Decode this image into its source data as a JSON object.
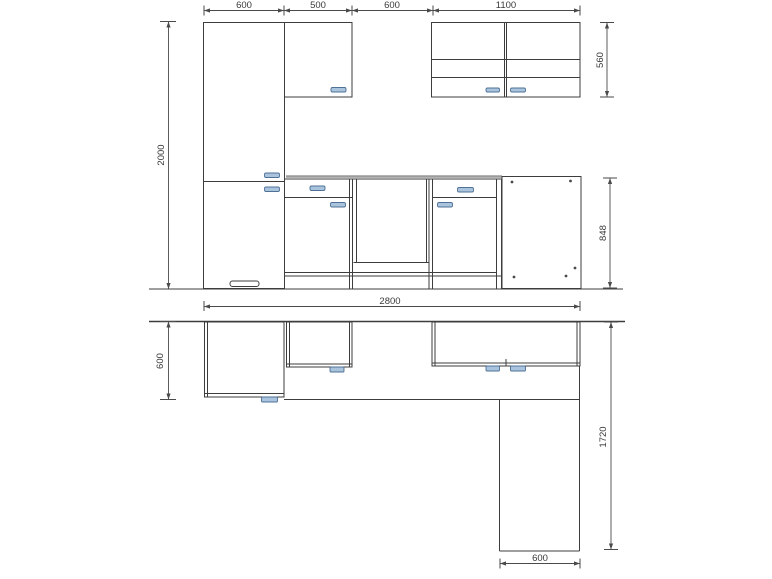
{
  "drawing": {
    "type": "kitchen-cad-drawing",
    "colors": {
      "line": "#3d3d3d",
      "worktop_gray": "#9b9b9b",
      "handle_fill": "#aac4dd",
      "handle_border": "#4f7196",
      "background": "#ffffff",
      "dimension_text": "#3a3a3a"
    },
    "dims": {
      "elevation": {
        "top": [
          "600",
          "500",
          "600",
          "1100"
        ],
        "height_left": "2000",
        "wall_cabinet_height": "560",
        "base_height": "848",
        "total_width": "2800"
      },
      "plan": {
        "depth_left": "600",
        "return_length": "1720",
        "return_width": "600"
      }
    }
  }
}
